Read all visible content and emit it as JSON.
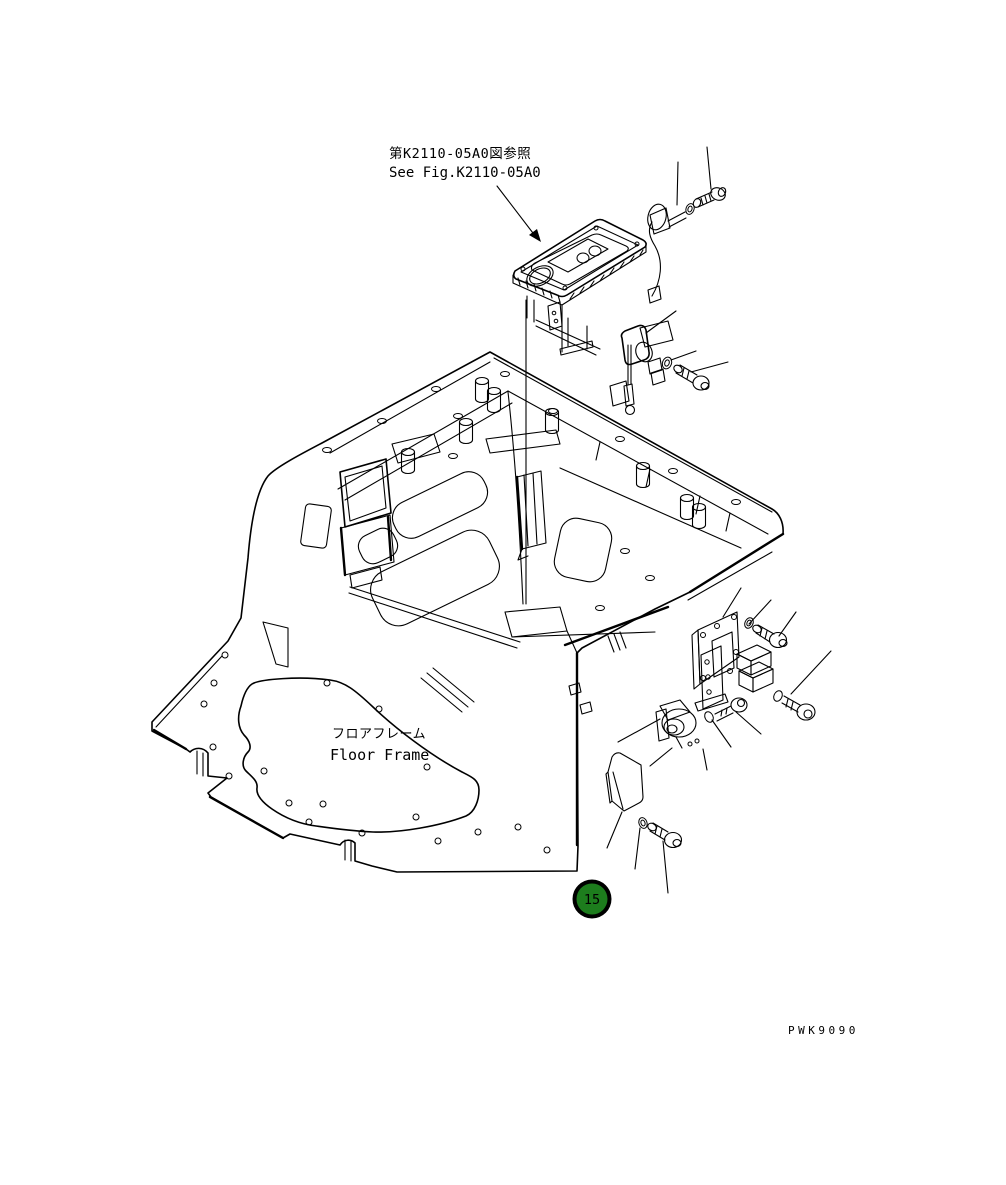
{
  "page": {
    "width": 1006,
    "height": 1185,
    "background_color": "#ffffff",
    "line_color": "#000000"
  },
  "figure_reference": {
    "line1_jp": "第K2110-05A0図参照",
    "line2_en": "See Fig.K2110-05A0"
  },
  "part_label": {
    "line1_jp": "フロアフレーム",
    "line2_en": "Floor Frame"
  },
  "callout": {
    "number": "15",
    "balloon_fill": "#1d7d1d",
    "balloon_ring": "#000000",
    "number_color": "#ffffff"
  },
  "drawing_number": "PWK9090"
}
